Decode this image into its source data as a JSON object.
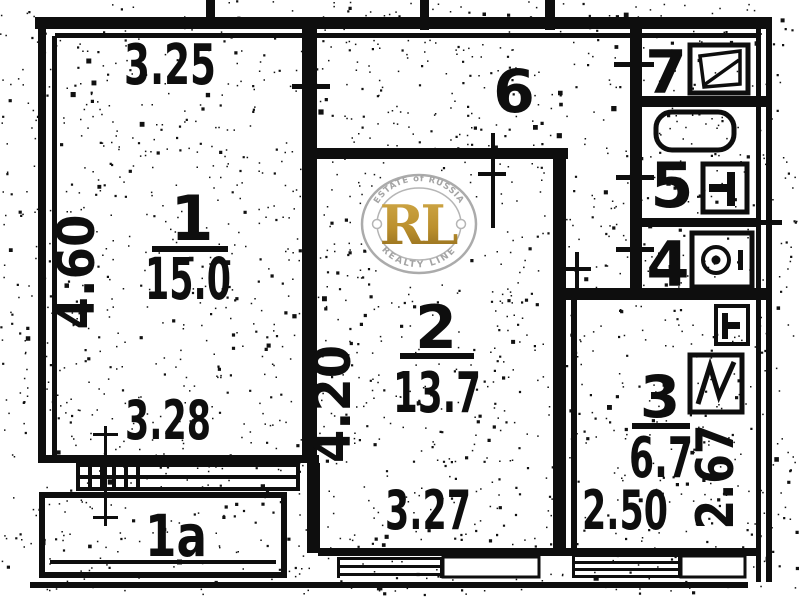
{
  "plan_type": "apartment-floor-plan-scan",
  "rooms": {
    "r1": {
      "number": "1",
      "area": "15.0"
    },
    "r1a": {
      "number": "1a"
    },
    "r2": {
      "number": "2",
      "area": "13.7"
    },
    "r3": {
      "number": "3",
      "area": "6.7"
    },
    "r4": {
      "number": "4"
    },
    "r5": {
      "number": "5"
    },
    "r6": {
      "number": "6"
    },
    "r7": {
      "number": "7"
    }
  },
  "dimensions": {
    "room1_top": "3.25",
    "room1_left": "4.60",
    "room1_bottom": "3.28",
    "room2_left": "4.20",
    "room2_bottom": "3.27",
    "room3_bottom": "2.50",
    "room3_right": "2.67"
  },
  "watermark": {
    "arc_top": "ESTATE of RUSSIA",
    "initials": "RL",
    "arc_bottom": "REALTY LINE"
  },
  "colors": {
    "ink": "#0e0e0e",
    "paper": "#ffffff",
    "stamp_gold_light": "#d2ab4a",
    "stamp_gold_dark": "#8a671a",
    "stamp_ring_gray": "#ababab"
  }
}
